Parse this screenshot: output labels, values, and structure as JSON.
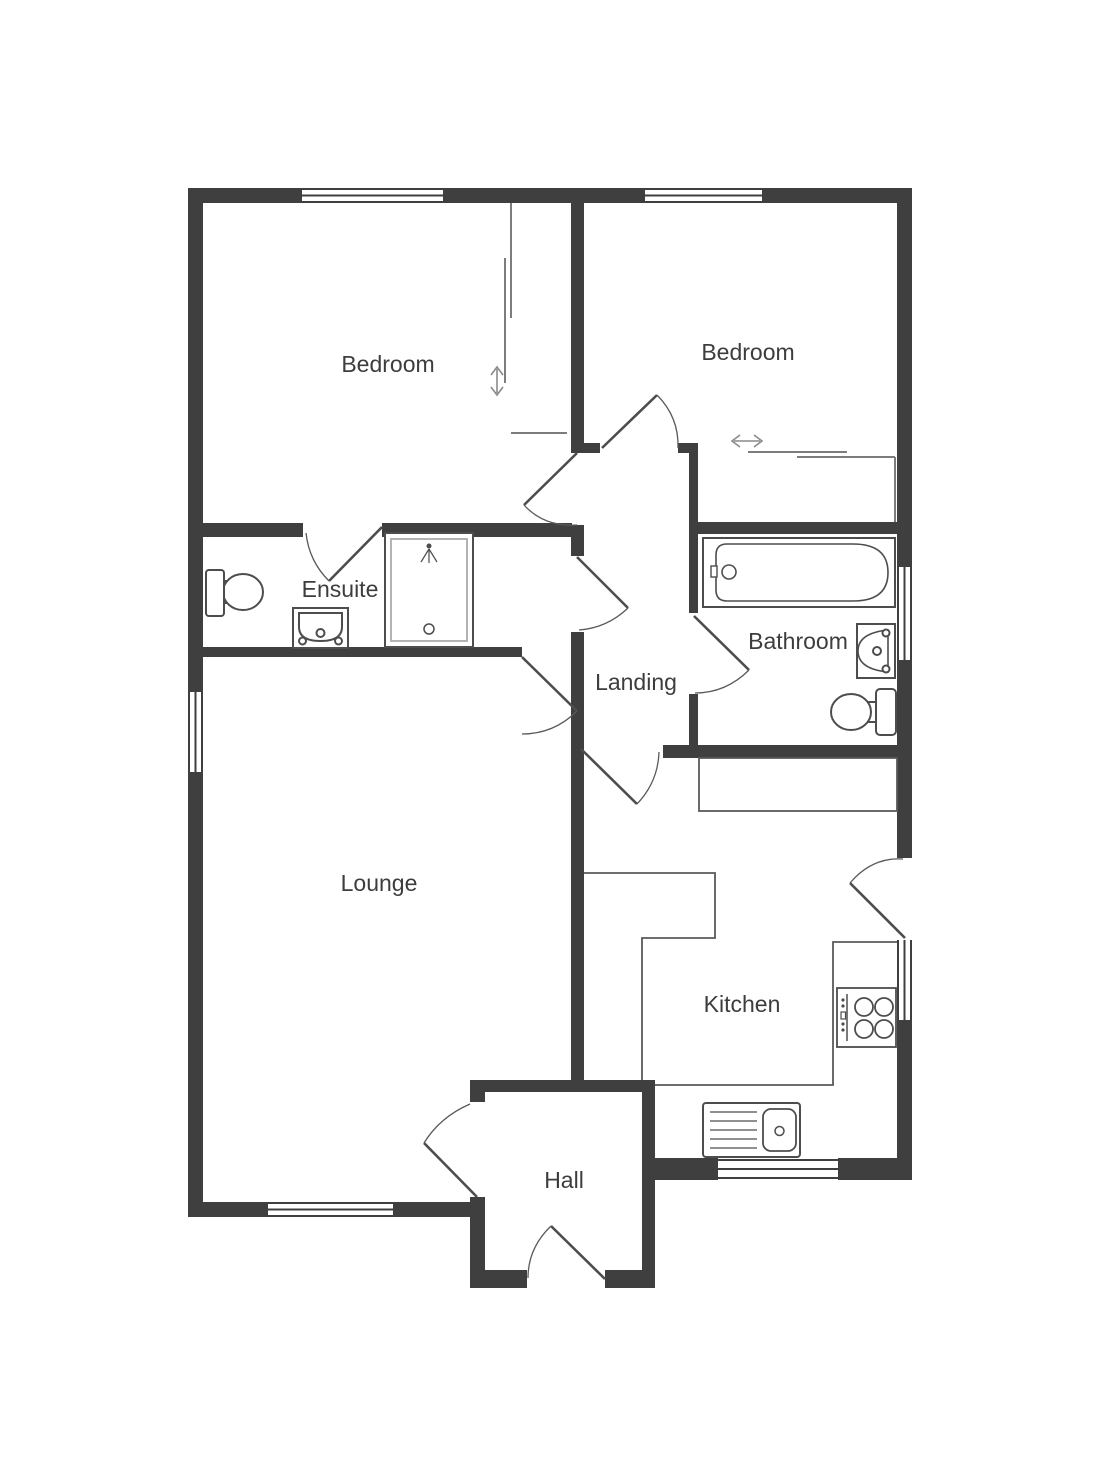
{
  "page": {
    "background": "#ffffff"
  },
  "floor_plan": {
    "rooms": [
      {
        "id": "bedroom-1",
        "label": "Bedroom"
      },
      {
        "id": "bedroom-2",
        "label": "Bedroom"
      },
      {
        "id": "ensuite",
        "label": "Ensuite"
      },
      {
        "id": "bathroom",
        "label": "Bathroom"
      },
      {
        "id": "landing",
        "label": "Landing"
      },
      {
        "id": "lounge",
        "label": "Lounge"
      },
      {
        "id": "kitchen",
        "label": "Kitchen"
      },
      {
        "id": "hall",
        "label": "Hall"
      }
    ],
    "colors": {
      "wall": "#3f3f3f",
      "fixture_line": "#4d4d4d",
      "counter_line": "#5a5a5a",
      "wardrobe_line": "#7d7d7d",
      "shower_frame": "#b3b3b3",
      "arrow": "#8a8a8a",
      "label_text": "#3d3d3d",
      "background": "#ffffff"
    },
    "fixtures": [
      "ensuite-toilet",
      "ensuite-basin",
      "ensuite-shower",
      "bathroom-bath",
      "bathroom-basin",
      "bathroom-toilet",
      "kitchen-hob",
      "kitchen-sink",
      "kitchen-counters"
    ],
    "symbols": {
      "windows": 7,
      "door_swings": 10,
      "sliding_wardrobes": 2
    },
    "arrows": [
      {
        "id": "sliding-door-vertical",
        "glyph": "vertical-double-arrow"
      },
      {
        "id": "sliding-door-horizontal",
        "glyph": "horizontal-double-arrow"
      }
    ]
  }
}
